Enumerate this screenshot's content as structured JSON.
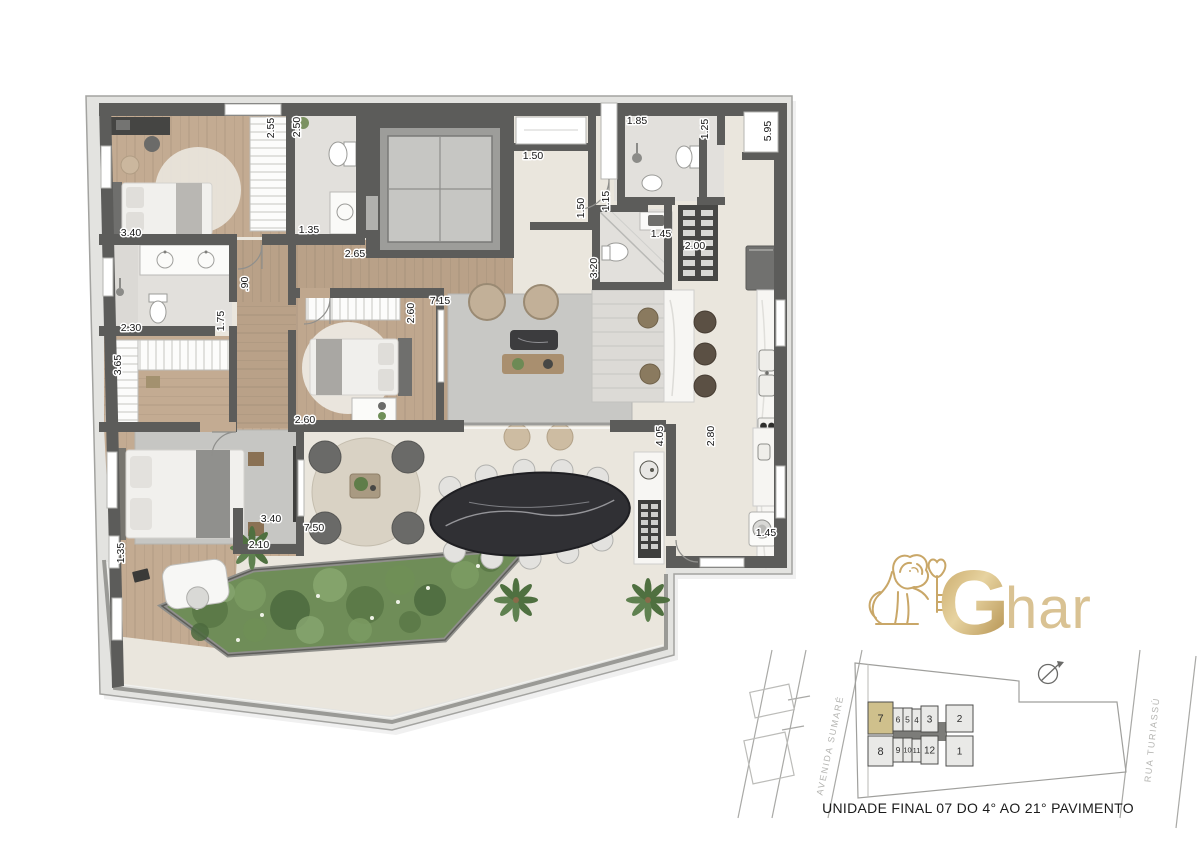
{
  "page": {
    "background": "#ffffff"
  },
  "colors": {
    "wall": "#5c5c5a",
    "slab": "#e3e3e0",
    "floor_beige": "#eae6dd",
    "floor_wood": "#c0a98f",
    "floor_marble": "#e2e0dc",
    "rug_gray": "#c8c8c5",
    "garden_green": "#6f8d58",
    "counter_white": "#f7f6f3",
    "stone_table": "#303034",
    "brand_gold": "#c9a768",
    "unit_highlight": "#cfc08c",
    "site_unit_gray": "#e9e9e7"
  },
  "floor_plan": {
    "dimensions": [
      {
        "text": "2.55",
        "x": 274,
        "y": 128,
        "rot": -90
      },
      {
        "text": "2.50",
        "x": 300,
        "y": 127,
        "rot": -90
      },
      {
        "text": "3.40",
        "x": 131,
        "y": 236,
        "rot": 0
      },
      {
        "text": "1.35",
        "x": 309,
        "y": 233,
        "rot": 0
      },
      {
        "text": "2.65",
        "x": 355,
        "y": 257,
        "rot": 0
      },
      {
        "text": ".90",
        "x": 248,
        "y": 284,
        "rot": -90
      },
      {
        "text": "1.75",
        "x": 224,
        "y": 321,
        "rot": -90
      },
      {
        "text": "2.30",
        "x": 131,
        "y": 331,
        "rot": 0
      },
      {
        "text": "3.65",
        "x": 121,
        "y": 365,
        "rot": -90
      },
      {
        "text": "2.60",
        "x": 414,
        "y": 313,
        "rot": -90
      },
      {
        "text": "7.15",
        "x": 440,
        "y": 304,
        "rot": 0
      },
      {
        "text": "2.60",
        "x": 305,
        "y": 423,
        "rot": 0
      },
      {
        "text": "3.40",
        "x": 271,
        "y": 522,
        "rot": 0
      },
      {
        "text": "7.50",
        "x": 314,
        "y": 531,
        "rot": 0
      },
      {
        "text": "2.10",
        "x": 259,
        "y": 548,
        "rot": 0
      },
      {
        "text": "1.35",
        "x": 124,
        "y": 553,
        "rot": -90
      },
      {
        "text": "1.50",
        "x": 533,
        "y": 159,
        "rot": 0
      },
      {
        "text": "1.50",
        "x": 584,
        "y": 208,
        "rot": -90
      },
      {
        "text": "1.85",
        "x": 637,
        "y": 124,
        "rot": 0
      },
      {
        "text": "1.25",
        "x": 708,
        "y": 129,
        "rot": -90
      },
      {
        "text": "5.95",
        "x": 771,
        "y": 131,
        "rot": -90
      },
      {
        "text": "1.15",
        "x": 609,
        "y": 201,
        "rot": -90
      },
      {
        "text": "1.45",
        "x": 661,
        "y": 237,
        "rot": 0
      },
      {
        "text": "2.00",
        "x": 695,
        "y": 249,
        "rot": 0
      },
      {
        "text": "3.20",
        "x": 597,
        "y": 268,
        "rot": -90
      },
      {
        "text": "4.05",
        "x": 663,
        "y": 436,
        "rot": -90
      },
      {
        "text": "2.80",
        "x": 714,
        "y": 436,
        "rot": -90
      },
      {
        "text": "1.45",
        "x": 766,
        "y": 536,
        "rot": 0
      }
    ]
  },
  "logo": {
    "g": "G",
    "rest": "har"
  },
  "site_plan": {
    "caption": "UNIDADE FINAL 07 DO 4° AO 21° PAVIMENTO",
    "highlighted_unit": "7",
    "streets": [
      {
        "name": "AVENIDA SUMARÉ",
        "x": 833,
        "y": 746,
        "rot": -78
      },
      {
        "name": "RUA TURIASSÚ",
        "x": 1155,
        "y": 740,
        "rot": -84
      }
    ],
    "units": [
      {
        "label": "7",
        "x": 868,
        "y": 702,
        "w": 25,
        "h": 32,
        "fs": 11,
        "highlight": true
      },
      {
        "label": "6",
        "x": 893,
        "y": 708,
        "w": 10,
        "h": 23,
        "fs": 8.5,
        "highlight": false
      },
      {
        "label": "5",
        "x": 903,
        "y": 708,
        "w": 9,
        "h": 23,
        "fs": 8.5,
        "highlight": false
      },
      {
        "label": "4",
        "x": 912,
        "y": 709,
        "w": 9,
        "h": 22,
        "fs": 8,
        "highlight": false
      },
      {
        "label": "3",
        "x": 921,
        "y": 706,
        "w": 17,
        "h": 26,
        "fs": 10,
        "highlight": false
      },
      {
        "label": "2",
        "x": 946,
        "y": 705,
        "w": 27,
        "h": 27,
        "fs": 10,
        "highlight": false
      },
      {
        "label": "8",
        "x": 868,
        "y": 736,
        "w": 25,
        "h": 30,
        "fs": 11,
        "highlight": false
      },
      {
        "label": "9",
        "x": 893,
        "y": 738,
        "w": 10,
        "h": 24,
        "fs": 8.5,
        "highlight": false
      },
      {
        "label": "10",
        "x": 903,
        "y": 738,
        "w": 9,
        "h": 24,
        "fs": 7.5,
        "highlight": false
      },
      {
        "label": "11",
        "x": 912,
        "y": 739,
        "w": 9,
        "h": 23,
        "fs": 7.5,
        "highlight": false
      },
      {
        "label": "12",
        "x": 921,
        "y": 736,
        "w": 17,
        "h": 28,
        "fs": 10,
        "highlight": false
      },
      {
        "label": "1",
        "x": 946,
        "y": 736,
        "w": 27,
        "h": 30,
        "fs": 10,
        "highlight": false
      }
    ]
  }
}
